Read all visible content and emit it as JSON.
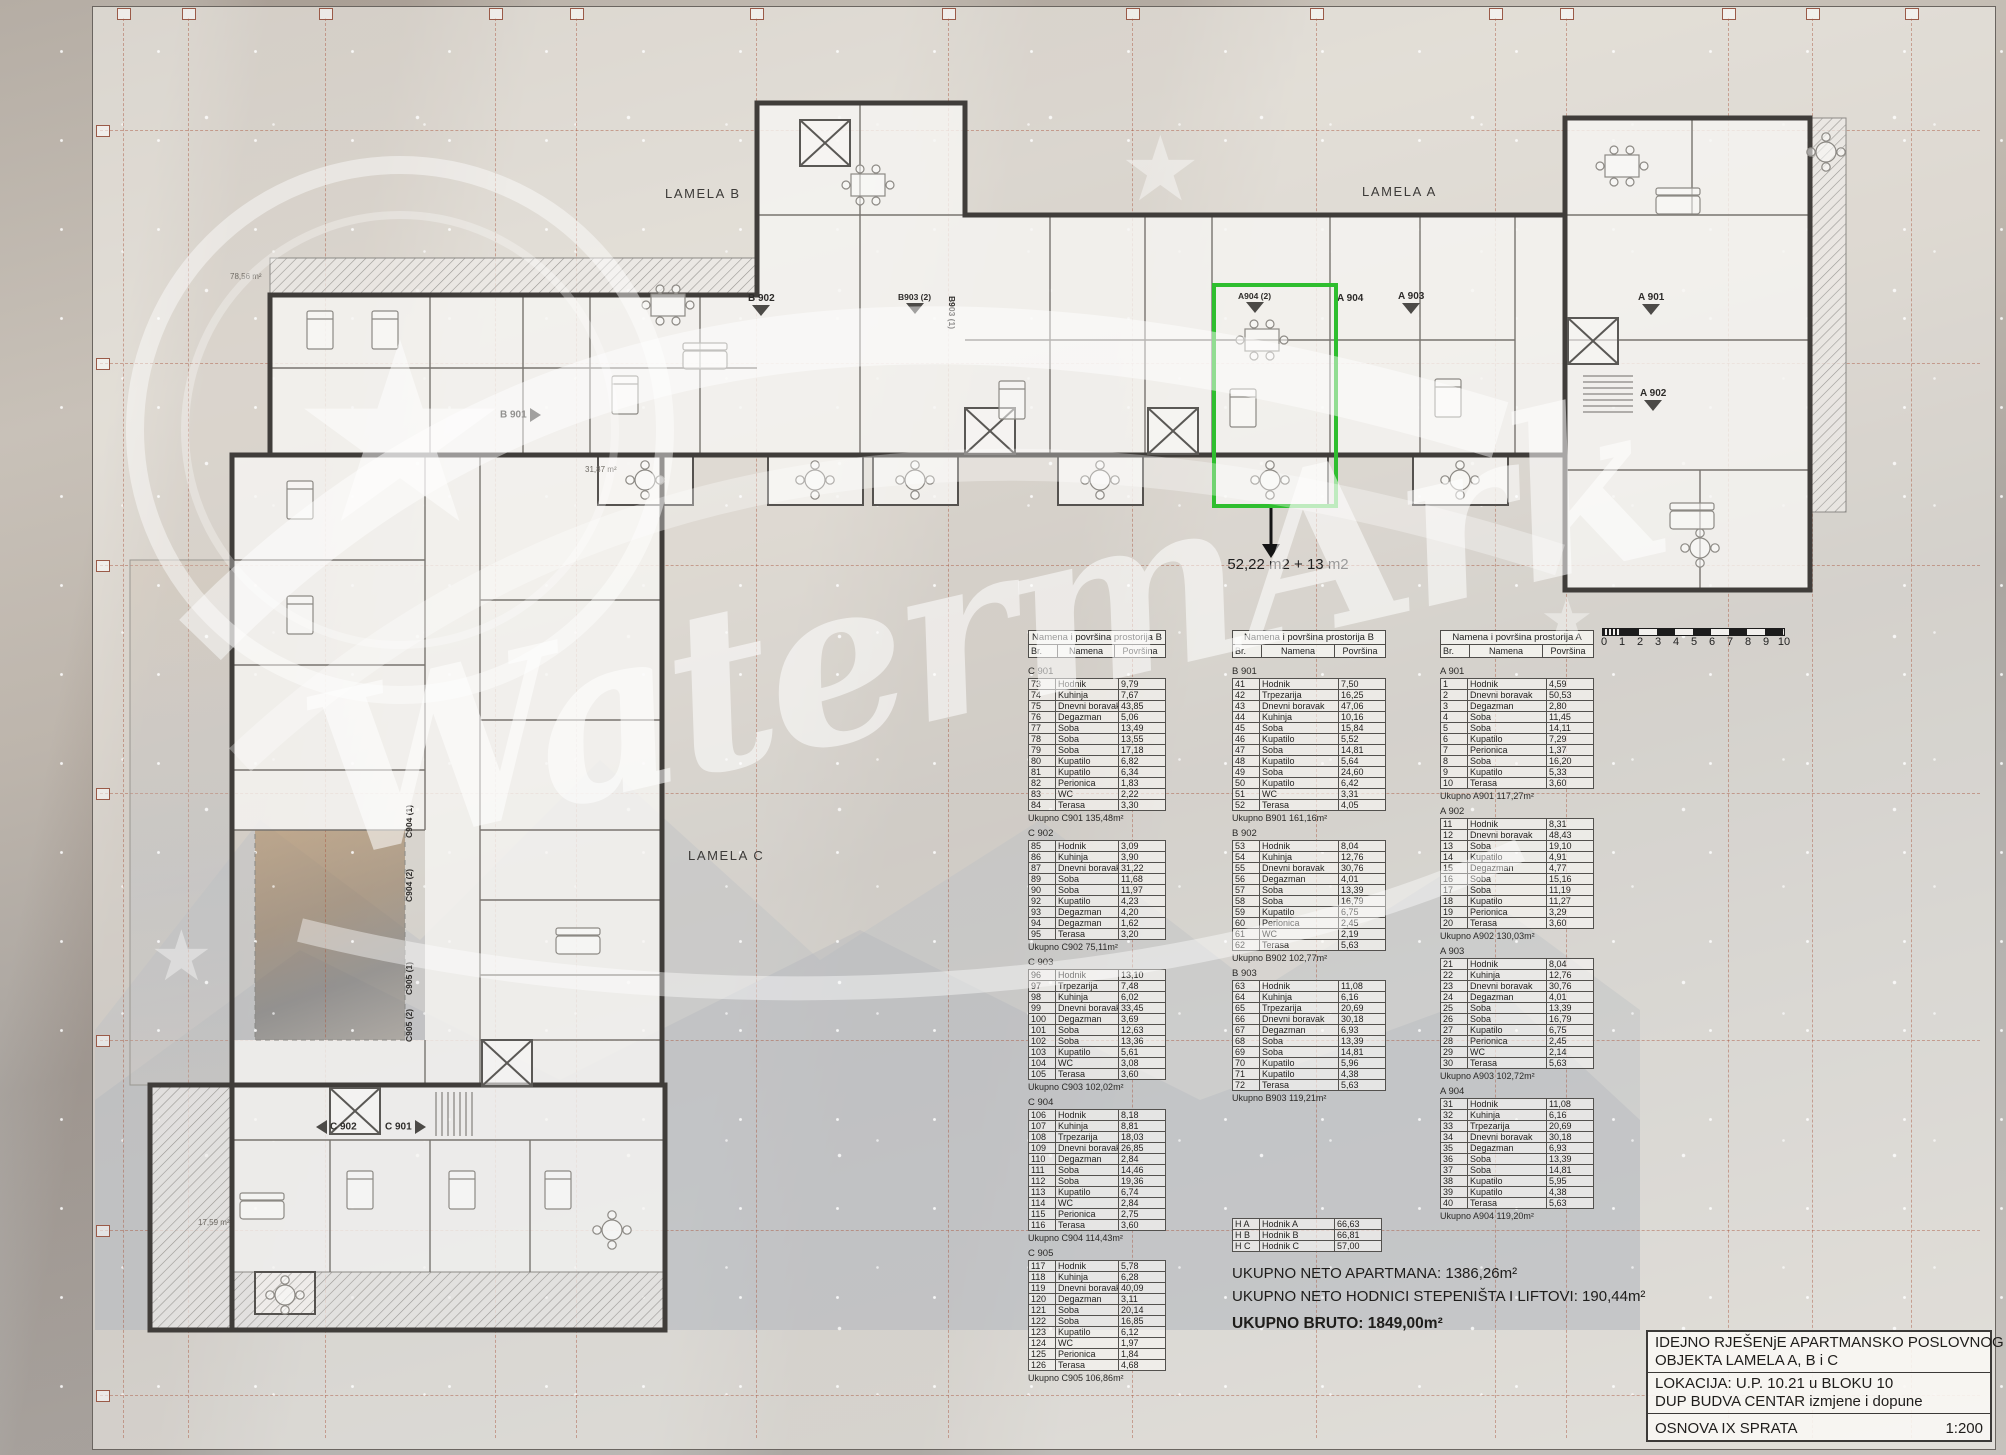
{
  "sheet": {
    "lamela_labels": {
      "b": "LAMELA B",
      "a": "LAMELA A",
      "c": "LAMELA C"
    },
    "unit_labels": {
      "b901": "B 901",
      "b902": "B 902",
      "b903_2": "B903 (2)",
      "b903_1": "B903 (1)",
      "a904_2": "A904 (2)",
      "a904": "A 904",
      "a903": "A 903",
      "a901": "A 901",
      "a902": "A 902",
      "c902": "C 902",
      "c901": "C 901",
      "c904_1": "C904 (1)",
      "c904_2": "C904 (2)",
      "c905_1": "C905 (1)",
      "c905_2": "C905 (2)"
    },
    "area_texts": {
      "t1": "78,56 m²",
      "t2": "31,87 m²",
      "t3": "17,59 m²"
    },
    "highlight": {
      "annotation": "52,22 m2 + 13 m2"
    },
    "watermark": {
      "text": "WatermArk",
      "star_icon": "★"
    },
    "accent_green": "#2fbe2f"
  },
  "tables": {
    "column_c": {
      "header_title": "Namena i površina prostorija B",
      "columns": [
        "Br.",
        "Namena",
        "Površina"
      ],
      "groups": [
        {
          "name": "C 901",
          "total": "Ukupno C901 135,48m²",
          "rows": [
            [
              "73",
              "Hodnik",
              "9,79"
            ],
            [
              "74",
              "Kuhinja",
              "7,67"
            ],
            [
              "75",
              "Dnevni boravak",
              "43,85"
            ],
            [
              "76",
              "Degazman",
              "5,06"
            ],
            [
              "77",
              "Soba",
              "13,49"
            ],
            [
              "78",
              "Soba",
              "13,55"
            ],
            [
              "79",
              "Soba",
              "17,18"
            ],
            [
              "80",
              "Kupatilo",
              "6,82"
            ],
            [
              "81",
              "Kupatilo",
              "6,34"
            ],
            [
              "82",
              "Perionica",
              "1,83"
            ],
            [
              "83",
              "WC",
              "2,22"
            ],
            [
              "84",
              "Terasa",
              "3,30"
            ]
          ]
        },
        {
          "name": "C 902",
          "total": "Ukupno C902 75,11m²",
          "rows": [
            [
              "85",
              "Hodnik",
              "3,09"
            ],
            [
              "86",
              "Kuhinja",
              "3,90"
            ],
            [
              "87",
              "Dnevni boravak",
              "31,22"
            ],
            [
              "89",
              "Soba",
              "11,68"
            ],
            [
              "90",
              "Soba",
              "11,97"
            ],
            [
              "92",
              "Kupatilo",
              "4,23"
            ],
            [
              "93",
              "Degazman",
              "4,20"
            ],
            [
              "94",
              "Degazman",
              "1,62"
            ],
            [
              "95",
              "Terasa",
              "3,20"
            ]
          ]
        },
        {
          "name": "C 903",
          "total": "Ukupno C903 102,02m²",
          "rows": [
            [
              "96",
              "Hodnik",
              "13,10"
            ],
            [
              "97",
              "Trpezarija",
              "7,48"
            ],
            [
              "98",
              "Kuhinja",
              "6,02"
            ],
            [
              "99",
              "Dnevni boravak",
              "33,45"
            ],
            [
              "100",
              "Degazman",
              "3,69"
            ],
            [
              "101",
              "Soba",
              "12,63"
            ],
            [
              "102",
              "Soba",
              "13,36"
            ],
            [
              "103",
              "Kupatilo",
              "5,61"
            ],
            [
              "104",
              "WC",
              "3,08"
            ],
            [
              "105",
              "Terasa",
              "3,60"
            ]
          ]
        },
        {
          "name": "C 904",
          "total": "Ukupno C904 114,43m²",
          "rows": [
            [
              "106",
              "Hodnik",
              "8,18"
            ],
            [
              "107",
              "Kuhinja",
              "8,81"
            ],
            [
              "108",
              "Trpezarija",
              "18,03"
            ],
            [
              "109",
              "Dnevni boravak",
              "26,85"
            ],
            [
              "110",
              "Degazman",
              "2,84"
            ],
            [
              "111",
              "Soba",
              "14,46"
            ],
            [
              "112",
              "Soba",
              "19,36"
            ],
            [
              "113",
              "Kupatilo",
              "6,74"
            ],
            [
              "114",
              "WC",
              "2,84"
            ],
            [
              "115",
              "Perionica",
              "2,75"
            ],
            [
              "116",
              "Terasa",
              "3,60"
            ]
          ]
        },
        {
          "name": "C 905",
          "total": "Ukupno C905 106,86m²",
          "rows": [
            [
              "117",
              "Hodnik",
              "5,78"
            ],
            [
              "118",
              "Kuhinja",
              "6,28"
            ],
            [
              "119",
              "Dnevni boravak",
              "40,09"
            ],
            [
              "120",
              "Degazman",
              "3,11"
            ],
            [
              "121",
              "Soba",
              "20,14"
            ],
            [
              "122",
              "Soba",
              "16,85"
            ],
            [
              "123",
              "Kupatilo",
              "6,12"
            ],
            [
              "124",
              "WC",
              "1,97"
            ],
            [
              "125",
              "Perionica",
              "1,84"
            ],
            [
              "126",
              "Terasa",
              "4,68"
            ]
          ]
        }
      ]
    },
    "column_b": {
      "header_title": "Namena i površina prostorija B",
      "columns": [
        "Br.",
        "Namena",
        "Površina"
      ],
      "groups": [
        {
          "name": "B 901",
          "total": "Ukupno B901 161,16m²",
          "rows": [
            [
              "41",
              "Hodnik",
              "7,50"
            ],
            [
              "42",
              "Trpezarija",
              "16,25"
            ],
            [
              "43",
              "Dnevni boravak",
              "47,06"
            ],
            [
              "44",
              "Kuhinja",
              "10,16"
            ],
            [
              "45",
              "Soba",
              "15,84"
            ],
            [
              "46",
              "Kupatilo",
              "5,52"
            ],
            [
              "47",
              "Soba",
              "14,81"
            ],
            [
              "48",
              "Kupatilo",
              "5,64"
            ],
            [
              "49",
              "Soba",
              "24,60"
            ],
            [
              "50",
              "Kupatilo",
              "6,42"
            ],
            [
              "51",
              "WC",
              "3,31"
            ],
            [
              "52",
              "Terasa",
              "4,05"
            ]
          ]
        },
        {
          "name": "B 902",
          "total": "Ukupno B902 102,77m²",
          "rows": [
            [
              "53",
              "Hodnik",
              "8,04"
            ],
            [
              "54",
              "Kuhinja",
              "12,76"
            ],
            [
              "55",
              "Dnevni boravak",
              "30,76"
            ],
            [
              "56",
              "Degazman",
              "4,01"
            ],
            [
              "57",
              "Soba",
              "13,39"
            ],
            [
              "58",
              "Soba",
              "16,79"
            ],
            [
              "59",
              "Kupatilo",
              "6,75"
            ],
            [
              "60",
              "Perionica",
              "2,45"
            ],
            [
              "61",
              "WC",
              "2,19"
            ],
            [
              "62",
              "Terasa",
              "5,63"
            ]
          ]
        },
        {
          "name": "B 903",
          "total": "Ukupno B903 119,21m²",
          "rows": [
            [
              "63",
              "Hodnik",
              "11,08"
            ],
            [
              "64",
              "Kuhinja",
              "6,16"
            ],
            [
              "65",
              "Trpezarija",
              "20,69"
            ],
            [
              "66",
              "Dnevni boravak",
              "30,18"
            ],
            [
              "67",
              "Degazman",
              "6,93"
            ],
            [
              "68",
              "Soba",
              "13,39"
            ],
            [
              "69",
              "Soba",
              "14,81"
            ],
            [
              "70",
              "Kupatilo",
              "5,96"
            ],
            [
              "71",
              "Kupatilo",
              "4,38"
            ],
            [
              "72",
              "Terasa",
              "5,63"
            ]
          ]
        }
      ],
      "summary_rows": [
        [
          "H A",
          "Hodnik A",
          "66,63"
        ],
        [
          "H B",
          "Hodnik B",
          "66,81"
        ],
        [
          "H C",
          "Hodnik C",
          "57,00"
        ]
      ]
    },
    "column_a": {
      "header_title": "Namena i površina prostorija A",
      "columns": [
        "Br.",
        "Namena",
        "Površina"
      ],
      "groups": [
        {
          "name": "A 901",
          "total": "Ukupno A901 117,27m²",
          "rows": [
            [
              "1",
              "Hodnik",
              "4,59"
            ],
            [
              "2",
              "Dnevni boravak",
              "50,53"
            ],
            [
              "3",
              "Degazman",
              "2,80"
            ],
            [
              "4",
              "Soba",
              "11,45"
            ],
            [
              "5",
              "Soba",
              "14,11"
            ],
            [
              "6",
              "Kupatilo",
              "7,29"
            ],
            [
              "7",
              "Perionica",
              "1,37"
            ],
            [
              "8",
              "Soba",
              "16,20"
            ],
            [
              "9",
              "Kupatilo",
              "5,33"
            ],
            [
              "10",
              "Terasa",
              "3,60"
            ]
          ]
        },
        {
          "name": "A 902",
          "total": "Ukupno A902 130,03m²",
          "rows": [
            [
              "11",
              "Hodnik",
              "8,31"
            ],
            [
              "12",
              "Dnevni boravak",
              "48,43"
            ],
            [
              "13",
              "Soba",
              "19,10"
            ],
            [
              "14",
              "Kupatilo",
              "4,91"
            ],
            [
              "15",
              "Degazman",
              "4,77"
            ],
            [
              "16",
              "Soba",
              "15,16"
            ],
            [
              "17",
              "Soba",
              "11,19"
            ],
            [
              "18",
              "Kupatilo",
              "11,27"
            ],
            [
              "19",
              "Perionica",
              "3,29"
            ],
            [
              "20",
              "Terasa",
              "3,60"
            ]
          ]
        },
        {
          "name": "A 903",
          "total": "Ukupno A903 102,72m²",
          "rows": [
            [
              "21",
              "Hodnik",
              "8,04"
            ],
            [
              "22",
              "Kuhinja",
              "12,76"
            ],
            [
              "23",
              "Dnevni boravak",
              "30,76"
            ],
            [
              "24",
              "Degazman",
              "4,01"
            ],
            [
              "25",
              "Soba",
              "13,39"
            ],
            [
              "26",
              "Soba",
              "16,79"
            ],
            [
              "27",
              "Kupatilo",
              "6,75"
            ],
            [
              "28",
              "Perionica",
              "2,45"
            ],
            [
              "29",
              "WC",
              "2,14"
            ],
            [
              "30",
              "Terasa",
              "5,63"
            ]
          ]
        },
        {
          "name": "A 904",
          "total": "Ukupno A904 119,20m²",
          "rows": [
            [
              "31",
              "Hodnik",
              "11,08"
            ],
            [
              "32",
              "Kuhinja",
              "6,16"
            ],
            [
              "33",
              "Trpezarija",
              "20,69"
            ],
            [
              "34",
              "Dnevni boravak",
              "30,18"
            ],
            [
              "35",
              "Degazman",
              "6,93"
            ],
            [
              "36",
              "Soba",
              "13,39"
            ],
            [
              "37",
              "Soba",
              "14,81"
            ],
            [
              "38",
              "Kupatilo",
              "5,95"
            ],
            [
              "39",
              "Kupatilo",
              "4,38"
            ],
            [
              "40",
              "Terasa",
              "5,63"
            ]
          ]
        }
      ]
    }
  },
  "totals": {
    "line1": "UKUPNO NETO APARTMANA: 1386,26m²",
    "line2": "UKUPNO NETO HODNICI STEPENIŠTA I LIFTOVI: 190,44m²",
    "line3": "UKUPNO BRUTO: 1849,00m²"
  },
  "scale_bar": {
    "labels": [
      "0",
      "1",
      "2",
      "3",
      "4",
      "5",
      "6",
      "7",
      "8",
      "9",
      "10"
    ]
  },
  "title_block": {
    "line1": "IDEJNO RJEŠENjE APARTMANSKO POSLOVNOG",
    "line2": "OBJEKTA LAMELA A, B i C",
    "line3": "LOKACIJA: U.P. 10.21 u BLOKU 10",
    "line4": "DUP BUDVA CENTAR izmjene i dopune",
    "line5": "OSNOVA IX SPRATA",
    "scale": "1:200"
  }
}
